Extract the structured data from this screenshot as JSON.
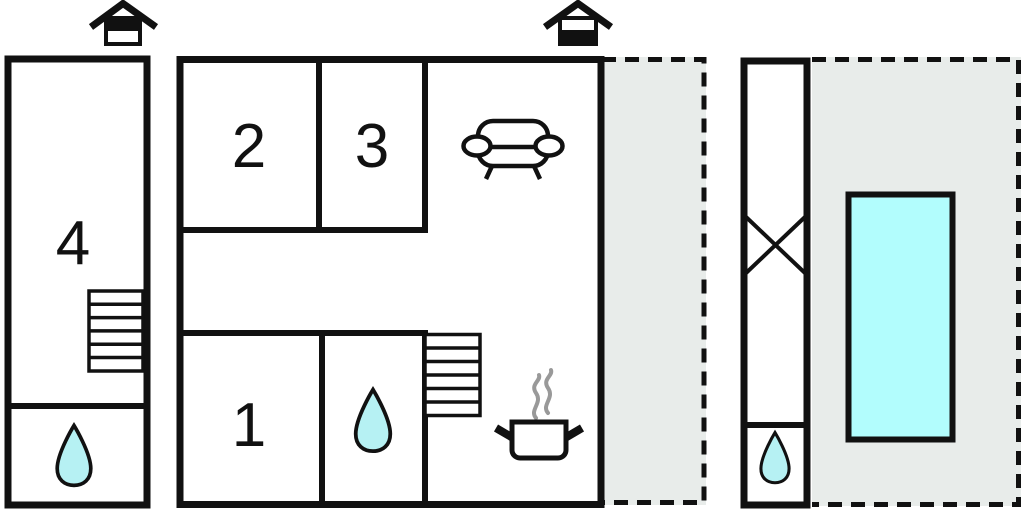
{
  "floor_plan": {
    "type": "vacation-house-floor-plan",
    "rooms": {
      "room1": {
        "label": "1"
      },
      "room2": {
        "label": "2"
      },
      "room3": {
        "label": "3"
      },
      "room4": {
        "label": "4"
      }
    },
    "icons": [
      "upper-floor-house-icon",
      "ground-floor-house-icon",
      "stairs-icon",
      "water-drop-icon",
      "sofa-icon",
      "cooking-pot-icon",
      "cross-marker-icon",
      "swimming-pool"
    ],
    "colors": {
      "wall": "#111111",
      "background": "#ffffff",
      "terrace_fill": "#e8ecea",
      "pool_fill": "#b2fdfd",
      "water_drop_fill": "#b6f1f3",
      "steam": "#999999"
    }
  }
}
